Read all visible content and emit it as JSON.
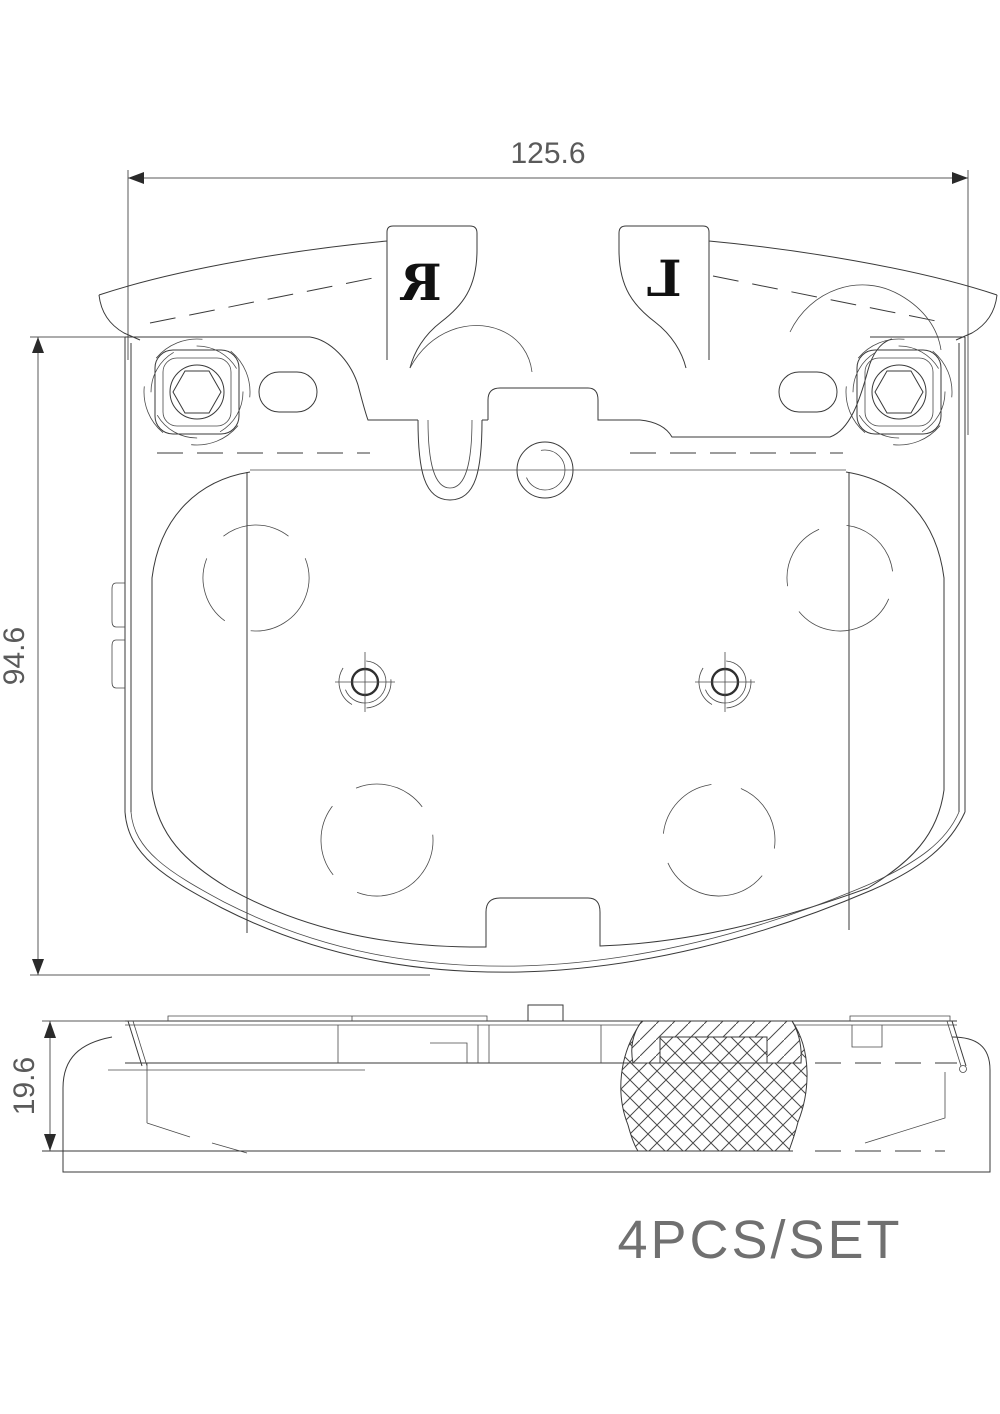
{
  "drawing": {
    "dimensions": {
      "width_label": "125.6",
      "height_label": "94.6",
      "thickness_label": "19.6"
    },
    "markings": {
      "right_pad_letter": "R",
      "left_pad_letter": "L"
    },
    "caption": "4PCS/SET",
    "colors": {
      "line": "#3a3a3a",
      "dimension_text": "#5a5a5a",
      "caption_text": "#707070",
      "background": "#ffffff"
    }
  }
}
